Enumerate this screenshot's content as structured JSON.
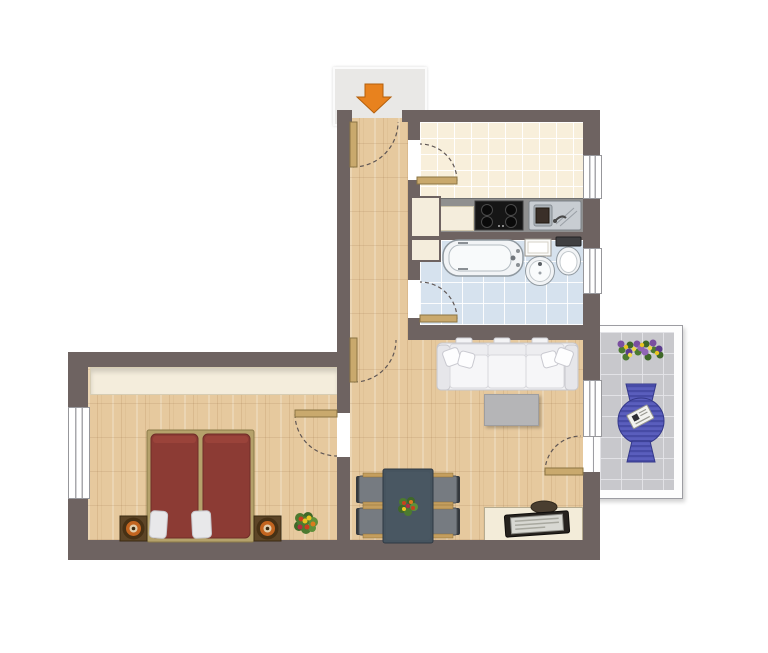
{
  "floorplan": {
    "kind": "apartment-floor-plan",
    "entrance": {
      "marker": "orange-down-arrow"
    },
    "rooms": [
      {
        "name": "hallway",
        "floor": "wood-parquet",
        "doors": [
          "entrance-door",
          "living-room-door",
          "bedroom-door"
        ]
      },
      {
        "name": "kitchen",
        "floor": "cream-tile",
        "fixtures": [
          "tall-cabinet",
          "counter",
          "cooktop-4-burners",
          "double-sink"
        ],
        "windows": 1
      },
      {
        "name": "bathroom",
        "floor": "blue-tile",
        "fixtures": [
          "bathtub",
          "wall-cabinet",
          "washbasin",
          "toilet"
        ],
        "windows": 1
      },
      {
        "name": "living-room",
        "floor": "wood-parquet",
        "furniture": [
          "three-seat-sofa",
          "coffee-table",
          "dining-table",
          "four-chairs",
          "flower-bouquet",
          "desk",
          "laptop",
          "desk-chair"
        ],
        "windows": 1
      },
      {
        "name": "bedroom",
        "floor": "wood-parquet",
        "furniture": [
          "built-in-wardrobe",
          "double-bed",
          "two-pillows",
          "nightstand-left",
          "nightstand-right",
          "two-lamps",
          "plant"
        ],
        "windows": 1
      },
      {
        "name": "balcony",
        "floor": "gray-tile",
        "furniture": [
          "striped-lounger",
          "magazine",
          "flower-box"
        ]
      }
    ],
    "doors": [
      "entrance",
      "kitchen",
      "bathroom",
      "bedroom",
      "living-room",
      "balcony"
    ],
    "colors": {
      "wall": "#6E6361",
      "wood": "#E6C99E",
      "kitchen-tile": "#F8EFDB",
      "bath-tile": "#D6E2EE",
      "balcony-tile": "#C8C8CC",
      "cream": "#F4EDDC",
      "counter": "#8F8F8F",
      "arrow": "#E8821E",
      "arrow-edge": "#B35F0C",
      "door-wood": "#C9A96D",
      "door-wood-edge": "#8A7442",
      "arc": "#5F5654",
      "bed-red": "#8C3B34",
      "bed-red-edge": "#6F2D28",
      "bed-frame": "#B5A26B",
      "nightstand": "#5D4527",
      "lamp": "#C2641F",
      "sofa": "#F1F1F3",
      "sofa-edge": "#C6C6CC",
      "coffee-table": "#B5B5B7",
      "dining-table": "#46545F",
      "chair": "#767B81",
      "chair-arm": "#C49E5E",
      "lounger": "#5A5EBD",
      "lounger-stripe": "#474BA6",
      "fixture": "#F2F4F6",
      "fixture-edge": "#9099A0",
      "desk": "#F3ECD9",
      "laptop": "#26221E",
      "window-line": "#A8A8AC",
      "plant": "#4C7A30",
      "flower-red": "#C8401F",
      "flower-purple": "#7A4FA0",
      "flower-yellow": "#E8C522",
      "flower-orange": "#D97B1F"
    }
  }
}
